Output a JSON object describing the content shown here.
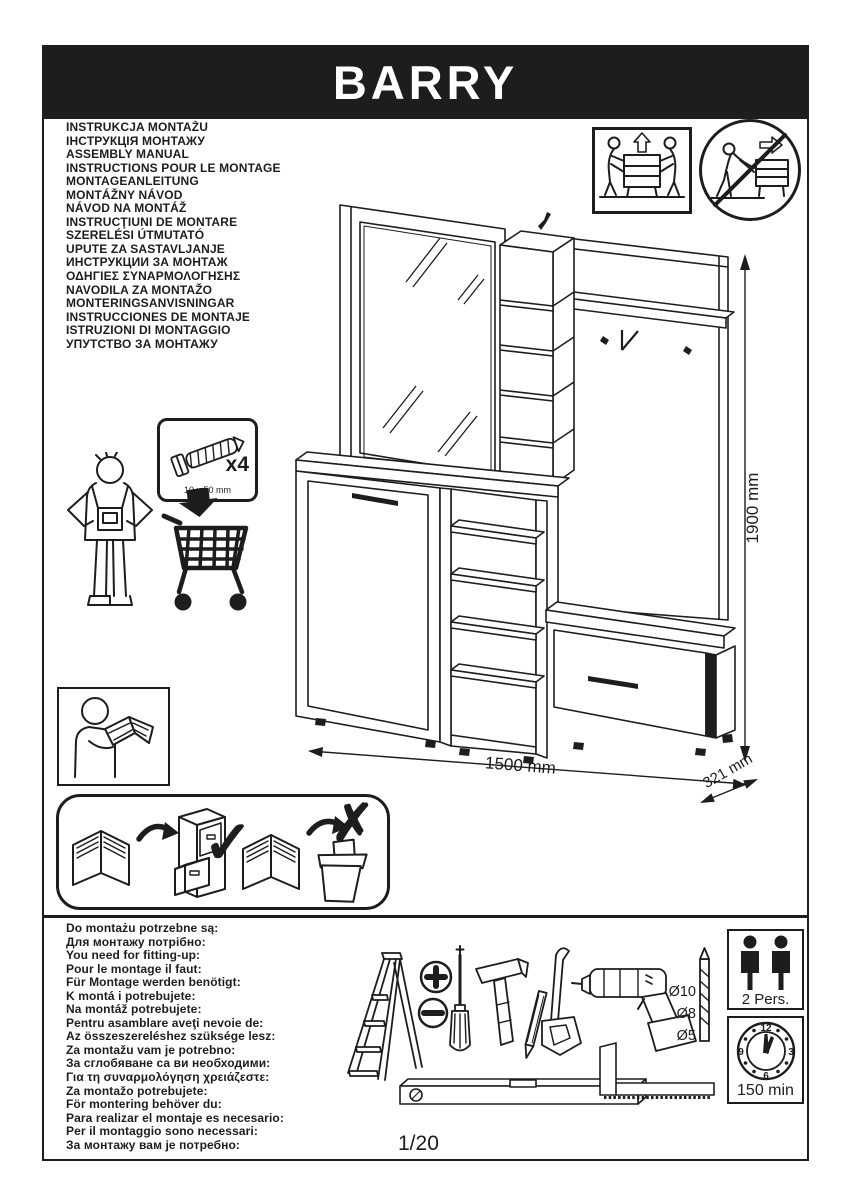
{
  "header": {
    "title": "BARRY"
  },
  "languages": [
    "INSTRUKCJA MONTAŻU",
    "ІНСТРУКЦІЯ МОНТАЖУ",
    "ASSEMBLY MANUAL",
    "INSTRUCTIONS POUR LE MONTAGE",
    "MONTAGEANLEITUNG",
    "MONTÁŽNY NÁVOD",
    "NÁVOD NA MONTÁŽ",
    "INSTRUCŢIUNI DE MONTARE",
    "SZERELÉSI ÚTMUTATÓ",
    "UPUTE ZA SASTAVLJANJE",
    "ИНСТРУКЦИИ ЗА МОНТАЖ",
    "ΟΔΗΓΙΕΣ ΣΥΝΑΡΜΟΛΟΓΗΣΗΣ",
    "NAVODILA ZA MONTAŽO",
    "MONTERINGSANVISNINGAR",
    "INSTRUCCIONES DE MONTAJE",
    "ISTRUZIONI DI MONTAGGIO",
    "УПУТСТВО ЗА МОНТАЖУ"
  ],
  "needs": [
    "Do montażu potrzebne są:",
    "Для монтажу потрібно:",
    "You need for fitting-up:",
    "Pour le montage il faut:",
    "Für Montage werden benötigt:",
    "K montá i potrebujete:",
    "Na montáž potrebujete:",
    "Pentru asamblare aveţi nevoie de:",
    "Az összeszereléshez szüksége lesz:",
    "Za montažu vam je potrebno:",
    "За сглобяване са ви необходими:",
    "Για τη συναρμολόγηση χρειάζεστε:",
    "Za montažo potrebujete:",
    "För montering behöver du:",
    "Para realizar el montaje es necesario:",
    "Per il montaggio sono necessari:",
    "За монтажу вам је потребно:"
  ],
  "hardware": {
    "quantity": "x4",
    "size": "10 x 50 mm"
  },
  "dimensions": {
    "height": "1900 mm",
    "width": "1500 mm",
    "depth": "321 mm"
  },
  "drill_sizes": [
    "Ø10",
    "Ø8",
    "Ø5"
  ],
  "badges": {
    "persons": "2 Pers.",
    "time": "150 min"
  },
  "clock": {
    "twelve": "12",
    "three": "3",
    "six": "6",
    "nine": "9"
  },
  "glyphs": {
    "check": "✓",
    "cross": "✗"
  },
  "footer": {
    "page_number": "1/20"
  },
  "colors": {
    "ink": "#1d1d1b",
    "paper": "#ffffff"
  }
}
